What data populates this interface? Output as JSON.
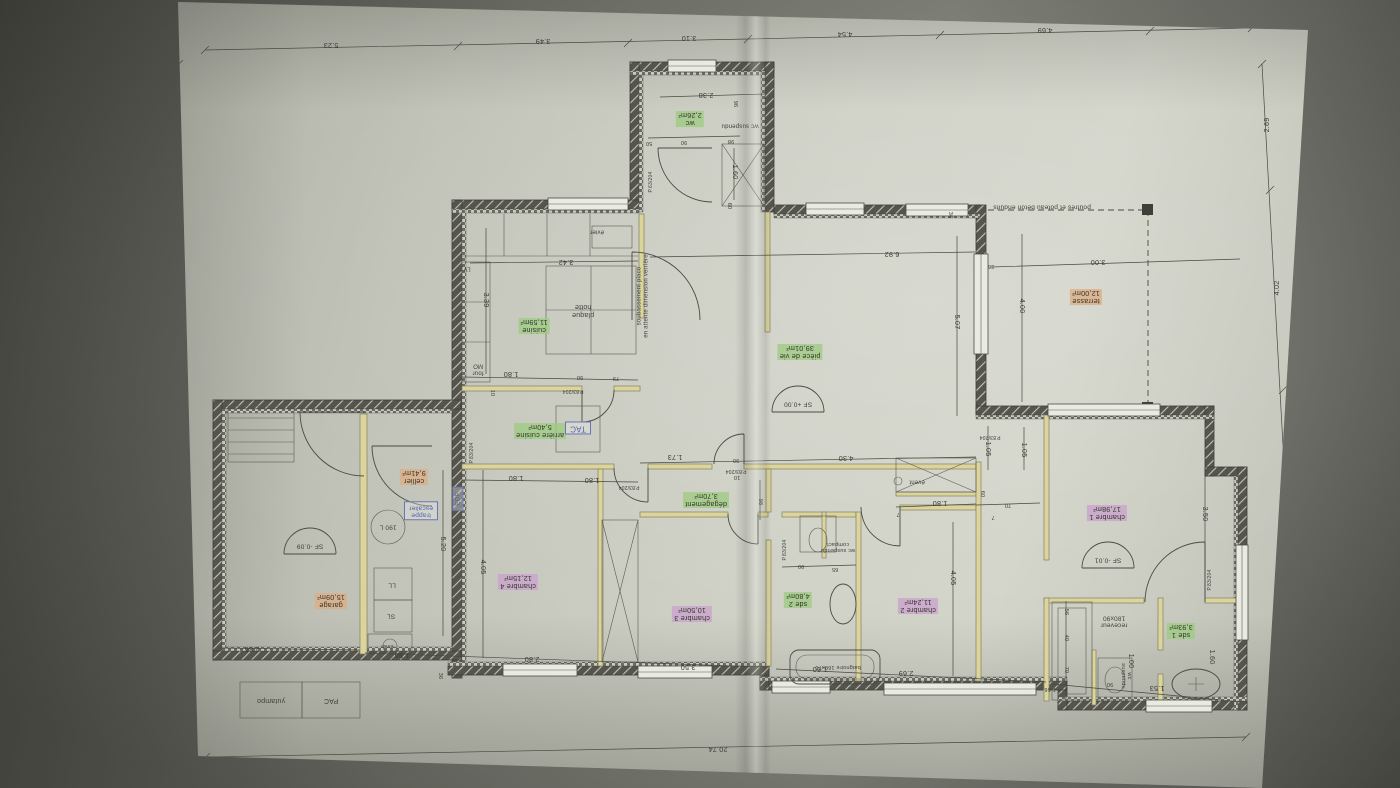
{
  "scene": {
    "kind": "photo of an architectural floor plan, drawing rotated 180°",
    "paper_color": "#c8cabf",
    "background_color": "#7b7d73",
    "accents": {
      "room_green": "#9ecc82",
      "room_pink": "#cba3cc",
      "room_orange": "#ddae85",
      "equipment_blue": "#5560ae"
    }
  },
  "labels": [
    {
      "t": "wc\n2,26m²",
      "x": 690,
      "y": 119,
      "c": "g"
    },
    {
      "t": "wc suspendu",
      "x": 740,
      "y": 125,
      "c": "t",
      "s": 6
    },
    {
      "t": "pièce de vie\n39,01m²",
      "x": 800,
      "y": 352,
      "c": "g"
    },
    {
      "t": "terrasse\n12,00m²",
      "x": 1086,
      "y": 297,
      "c": "o"
    },
    {
      "t": "poutres et poteau beton enduits",
      "x": 1042,
      "y": 207,
      "c": "t",
      "s": 6.5
    },
    {
      "t": "cuisine\n11,59m²",
      "x": 534,
      "y": 326,
      "c": "g"
    },
    {
      "t": "plaque\nhotte",
      "x": 583,
      "y": 310,
      "c": "t",
      "s": 7
    },
    {
      "t": "évier",
      "x": 597,
      "y": 231,
      "c": "t",
      "s": 6
    },
    {
      "t": "LV",
      "x": 467,
      "y": 268,
      "c": "t",
      "s": 6
    },
    {
      "t": "four\nMO",
      "x": 478,
      "y": 369,
      "c": "t",
      "s": 6
    },
    {
      "t": "soubassement placo\nen attente dimension verrière",
      "x": 643,
      "y": 296,
      "c": "t",
      "s": 6,
      "r": 270
    },
    {
      "t": "arrière cuisine\n5,40m²",
      "x": 540,
      "y": 431,
      "c": "g"
    },
    {
      "t": "TAC",
      "x": 578,
      "y": 428,
      "c": "b",
      "s": 8
    },
    {
      "t": "dégagement\n3,70m²",
      "x": 706,
      "y": 500,
      "c": "g"
    },
    {
      "t": "chambre 4\n12,15m²",
      "x": 518,
      "y": 582,
      "c": "p"
    },
    {
      "t": "chambre 3\n10,50m²",
      "x": 692,
      "y": 614,
      "c": "p"
    },
    {
      "t": "sde 2\n4,80m²",
      "x": 798,
      "y": 600,
      "c": "g"
    },
    {
      "t": "wc suspendu\ncompact",
      "x": 838,
      "y": 547,
      "c": "t",
      "s": 5.5
    },
    {
      "t": "baignoire 160x70",
      "x": 838,
      "y": 667,
      "c": "t",
      "s": 5.5
    },
    {
      "t": "chambre 2\n11,24m²",
      "x": 918,
      "y": 606,
      "c": "p"
    },
    {
      "t": "évent",
      "x": 917,
      "y": 481,
      "c": "t",
      "s": 6
    },
    {
      "t": "chambre 1\n17,98m²",
      "x": 1107,
      "y": 513,
      "c": "p"
    },
    {
      "t": "sde 1\n3,93m²",
      "x": 1181,
      "y": 631,
      "c": "g"
    },
    {
      "t": "receveur\n180x90",
      "x": 1114,
      "y": 621,
      "c": "t",
      "s": 6.5
    },
    {
      "t": "wc\nsuspendu",
      "x": 1126,
      "y": 676,
      "c": "t",
      "s": 5.5,
      "r": 90
    },
    {
      "t": "cellier\n9,41m²",
      "x": 414,
      "y": 477,
      "c": "o"
    },
    {
      "t": "trappe\nescalier",
      "x": 421,
      "y": 511,
      "c": "b",
      "s": 6.5
    },
    {
      "t": "190 L",
      "x": 388,
      "y": 527,
      "c": "t",
      "s": 6.5
    },
    {
      "t": "EDF",
      "x": 458,
      "y": 499,
      "c": "b",
      "s": 6.5,
      "r": 270
    },
    {
      "t": "LL",
      "x": 392,
      "y": 585,
      "c": "t",
      "s": 6.5
    },
    {
      "t": "SL",
      "x": 391,
      "y": 616,
      "c": "t",
      "s": 6.5
    },
    {
      "t": "évier",
      "x": 387,
      "y": 646,
      "c": "t",
      "s": 5.5
    },
    {
      "t": "garage\n15,09m²",
      "x": 331,
      "y": 601,
      "c": "o"
    },
    {
      "t": "PAC",
      "x": 331,
      "y": 700,
      "c": "t",
      "s": 7
    },
    {
      "t": "yutampo",
      "x": 271,
      "y": 700,
      "c": "t",
      "s": 7
    },
    {
      "t": "SF +0.00",
      "x": 798,
      "y": 404,
      "c": "sf",
      "s": 6.5
    },
    {
      "t": "SF -0.09",
      "x": 310,
      "y": 546,
      "c": "sf",
      "s": 6.5
    },
    {
      "t": "SF -0.01",
      "x": 1108,
      "y": 560,
      "c": "sf",
      "s": 6.5
    },
    {
      "t": "P.63/204",
      "x": 652,
      "y": 182,
      "c": "t",
      "s": 5,
      "r": 270
    },
    {
      "t": "P.83/204",
      "x": 573,
      "y": 390,
      "c": "t",
      "s": 5
    },
    {
      "t": "P.83/204",
      "x": 629,
      "y": 486,
      "c": "t",
      "s": 5
    },
    {
      "t": "P.83/204",
      "x": 736,
      "y": 470,
      "c": "t",
      "s": 5
    },
    {
      "t": "P.83/204",
      "x": 990,
      "y": 436,
      "c": "t",
      "s": 5
    },
    {
      "t": "P.83/204",
      "x": 786,
      "y": 550,
      "c": "t",
      "s": 5,
      "r": 270
    },
    {
      "t": "P.83/204",
      "x": 473,
      "y": 453,
      "c": "t",
      "s": 5,
      "r": 270
    },
    {
      "t": "P.83/204",
      "x": 1211,
      "y": 580,
      "c": "t",
      "s": 5,
      "r": 270
    },
    {
      "t": "5.23",
      "x": 331,
      "y": 45,
      "c": "d"
    },
    {
      "t": "3.49",
      "x": 543,
      "y": 41,
      "c": "d"
    },
    {
      "t": "3.10",
      "x": 689,
      "y": 38,
      "c": "d"
    },
    {
      "t": "4.54",
      "x": 845,
      "y": 34,
      "c": "d"
    },
    {
      "t": "4.69",
      "x": 1045,
      "y": 30,
      "c": "d"
    },
    {
      "t": "2.69",
      "x": 1267,
      "y": 125,
      "c": "d",
      "r": 270
    },
    {
      "t": "4.02",
      "x": 1277,
      "y": 288,
      "c": "d",
      "r": 270
    },
    {
      "t": "5.89",
      "x": 1290,
      "y": 540,
      "c": "d",
      "r": 270
    },
    {
      "t": "12.58",
      "x": 174,
      "y": 390,
      "c": "d",
      "r": 90
    },
    {
      "t": "20.74",
      "x": 718,
      "y": 749,
      "c": "d"
    },
    {
      "t": "2.38",
      "x": 706,
      "y": 95,
      "c": "d"
    },
    {
      "t": "96",
      "x": 735,
      "y": 104,
      "c": "d",
      "r": 90,
      "s": 5.5
    },
    {
      "t": "50",
      "x": 649,
      "y": 143,
      "c": "d",
      "s": 5.5
    },
    {
      "t": "90",
      "x": 684,
      "y": 142,
      "c": "d",
      "s": 5.5
    },
    {
      "t": "98",
      "x": 731,
      "y": 141,
      "c": "d",
      "s": 5.5
    },
    {
      "t": "1.60",
      "x": 735,
      "y": 172,
      "c": "d",
      "r": 90
    },
    {
      "t": "60",
      "x": 729,
      "y": 206,
      "c": "d",
      "r": 90,
      "s": 5.5
    },
    {
      "t": "3.42",
      "x": 566,
      "y": 262,
      "c": "d"
    },
    {
      "t": "3.39",
      "x": 486,
      "y": 300,
      "c": "d",
      "r": 90
    },
    {
      "t": "6.92",
      "x": 892,
      "y": 254,
      "c": "d"
    },
    {
      "t": "36",
      "x": 950,
      "y": 215,
      "c": "d",
      "r": 90,
      "s": 5.5
    },
    {
      "t": "36",
      "x": 991,
      "y": 266,
      "c": "d",
      "s": 5.5
    },
    {
      "t": "3.00",
      "x": 1098,
      "y": 262,
      "c": "d"
    },
    {
      "t": "4.00",
      "x": 1022,
      "y": 306,
      "c": "d",
      "r": 90
    },
    {
      "t": "5.07",
      "x": 957,
      "y": 322,
      "c": "d",
      "r": 90
    },
    {
      "t": "1.80",
      "x": 511,
      "y": 374,
      "c": "d"
    },
    {
      "t": "90",
      "x": 580,
      "y": 377,
      "c": "d",
      "s": 5.5
    },
    {
      "t": "79",
      "x": 616,
      "y": 378,
      "c": "d",
      "s": 5.5
    },
    {
      "t": "10",
      "x": 492,
      "y": 393,
      "c": "d",
      "r": 90,
      "s": 5.5
    },
    {
      "t": "1.80",
      "x": 516,
      "y": 478,
      "c": "d"
    },
    {
      "t": "1.80",
      "x": 592,
      "y": 480,
      "c": "d"
    },
    {
      "t": "5.20",
      "x": 443,
      "y": 544,
      "c": "d",
      "r": 90
    },
    {
      "t": "1.73",
      "x": 675,
      "y": 457,
      "c": "d"
    },
    {
      "t": "90",
      "x": 736,
      "y": 460,
      "c": "d",
      "s": 5.5
    },
    {
      "t": "4.30",
      "x": 846,
      "y": 458,
      "c": "d"
    },
    {
      "t": "98",
      "x": 760,
      "y": 502,
      "c": "d",
      "r": 90,
      "s": 5.5
    },
    {
      "t": "10",
      "x": 737,
      "y": 477,
      "c": "d",
      "s": 5.5
    },
    {
      "t": "1.05",
      "x": 988,
      "y": 449,
      "c": "d",
      "r": 90
    },
    {
      "t": "1.05",
      "x": 1024,
      "y": 450,
      "c": "d",
      "r": 90
    },
    {
      "t": "60",
      "x": 982,
      "y": 494,
      "c": "d",
      "r": 90,
      "s": 5.5
    },
    {
      "t": "70",
      "x": 1008,
      "y": 505,
      "c": "d",
      "s": 5.5
    },
    {
      "t": "1.80",
      "x": 940,
      "y": 503,
      "c": "d"
    },
    {
      "t": "7",
      "x": 898,
      "y": 514,
      "c": "d",
      "s": 5.5
    },
    {
      "t": "7",
      "x": 993,
      "y": 517,
      "c": "d",
      "s": 5.5
    },
    {
      "t": "4.05",
      "x": 483,
      "y": 567,
      "c": "d",
      "r": 90
    },
    {
      "t": "4.05",
      "x": 953,
      "y": 578,
      "c": "d",
      "r": 90
    },
    {
      "t": "3.50",
      "x": 1205,
      "y": 514,
      "c": "d",
      "r": 90
    },
    {
      "t": "90",
      "x": 801,
      "y": 566,
      "c": "d",
      "s": 5.5
    },
    {
      "t": "65",
      "x": 835,
      "y": 569,
      "c": "d",
      "s": 5.5
    },
    {
      "t": "2.86",
      "x": 252,
      "y": 649,
      "c": "d"
    },
    {
      "t": "1.86",
      "x": 402,
      "y": 655,
      "c": "d"
    },
    {
      "t": "2.80",
      "x": 532,
      "y": 659,
      "c": "d"
    },
    {
      "t": "3.50",
      "x": 688,
      "y": 667,
      "c": "d"
    },
    {
      "t": "36",
      "x": 440,
      "y": 676,
      "c": "d",
      "r": 90,
      "s": 5.5
    },
    {
      "t": "1.60",
      "x": 820,
      "y": 669,
      "c": "d"
    },
    {
      "t": "2.69",
      "x": 906,
      "y": 673,
      "c": "d"
    },
    {
      "t": "56",
      "x": 1066,
      "y": 612,
      "c": "d",
      "r": 90,
      "s": 5.5
    },
    {
      "t": "40",
      "x": 1066,
      "y": 638,
      "c": "d",
      "r": 90,
      "s": 5.5
    },
    {
      "t": "70",
      "x": 1066,
      "y": 670,
      "c": "d",
      "r": 90,
      "s": 5.5
    },
    {
      "t": "1.00",
      "x": 1131,
      "y": 661,
      "c": "d",
      "r": 90
    },
    {
      "t": "90",
      "x": 1110,
      "y": 684,
      "c": "d",
      "s": 5.5
    },
    {
      "t": "1.53",
      "x": 1157,
      "y": 688,
      "c": "d"
    },
    {
      "t": "1.66",
      "x": 1050,
      "y": 689,
      "c": "d",
      "s": 5.5
    },
    {
      "t": "1.60",
      "x": 1212,
      "y": 657,
      "c": "d",
      "r": 90
    }
  ]
}
